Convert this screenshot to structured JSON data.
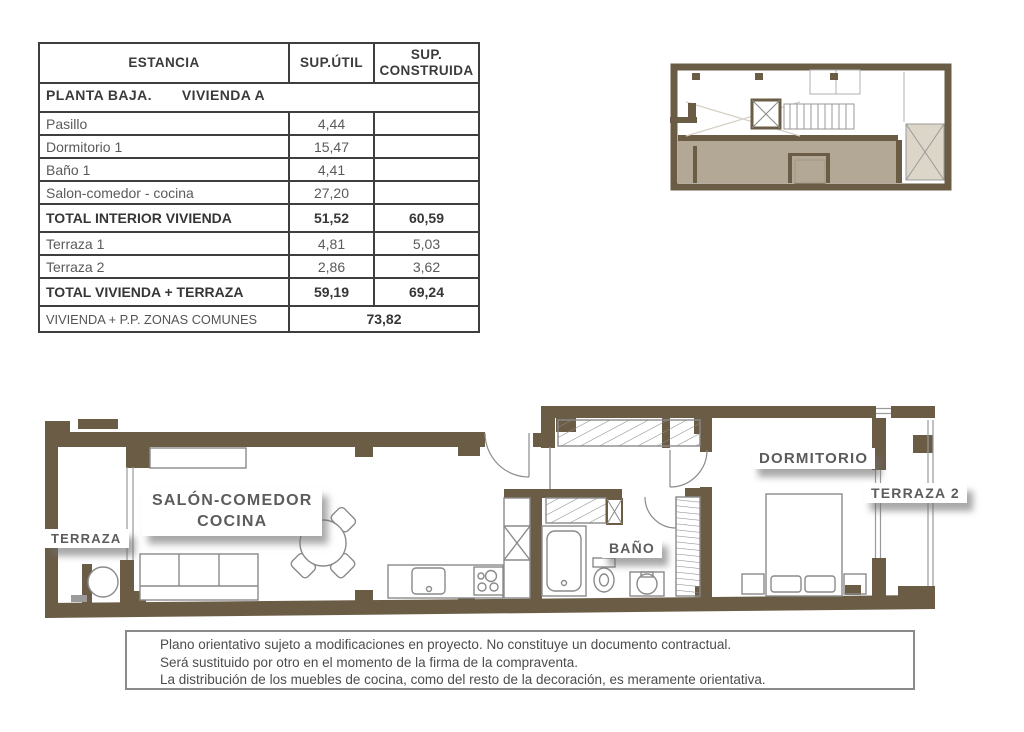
{
  "area_table": {
    "headers": {
      "estancia": "ESTANCIA",
      "util": "SUP.ÚTIL",
      "construida": "SUP. CONSTRUIDA"
    },
    "section": {
      "part1": "PLANTA BAJA.",
      "part2": "VIVIENDA A"
    },
    "rows": [
      {
        "label": "Pasillo",
        "util": "4,44",
        "construida": ""
      },
      {
        "label": "Dormitorio 1",
        "util": "15,47",
        "construida": ""
      },
      {
        "label": "Baño 1",
        "util": "4,41",
        "construida": ""
      },
      {
        "label": "Salon-comedor - cocina",
        "util": "27,20",
        "construida": ""
      },
      {
        "label": "TOTAL INTERIOR VIVIENDA",
        "util": "51,52",
        "construida": "60,59"
      },
      {
        "label": "Terraza 1",
        "util": "4,81",
        "construida": "5,03"
      },
      {
        "label": "Terraza 2",
        "util": "2,86",
        "construida": "3,62"
      },
      {
        "label": "TOTAL VIVIENDA + TERRAZA",
        "util": "59,19",
        "construida": "69,24"
      }
    ],
    "footer": {
      "label": "VIVIENDA + P.P. ZONAS COMUNES",
      "value": "73,82"
    }
  },
  "floor_plan": {
    "labels": {
      "terraza": "TERRAZA",
      "salon_line1": "SALÓN-COMEDOR",
      "salon_line2": "COCINA",
      "bano": "BAÑO",
      "dormitorio": "DORMITORIO",
      "terraza2": "TERRAZA 2"
    }
  },
  "disclaimer": {
    "lines": [
      "Plano orientativo sujeto a modificaciones en proyecto. No constituye un documento contractual.",
      "Será sustituido por otro en el momento de la firma de la compraventa.",
      "La distribución de los muebles de cocina, como del resto de la decoración, es meramente orientativa."
    ]
  },
  "colors": {
    "wall_brown": "#6b5c45",
    "floor_shade_tan": "#b3a795",
    "courtyard_light": "#dcd6c8",
    "drawing_line_gray": "#8a8a8a",
    "table_border": "#3e3e3e",
    "text_dark": "#363636",
    "text_gray": "#5a5a5a"
  }
}
